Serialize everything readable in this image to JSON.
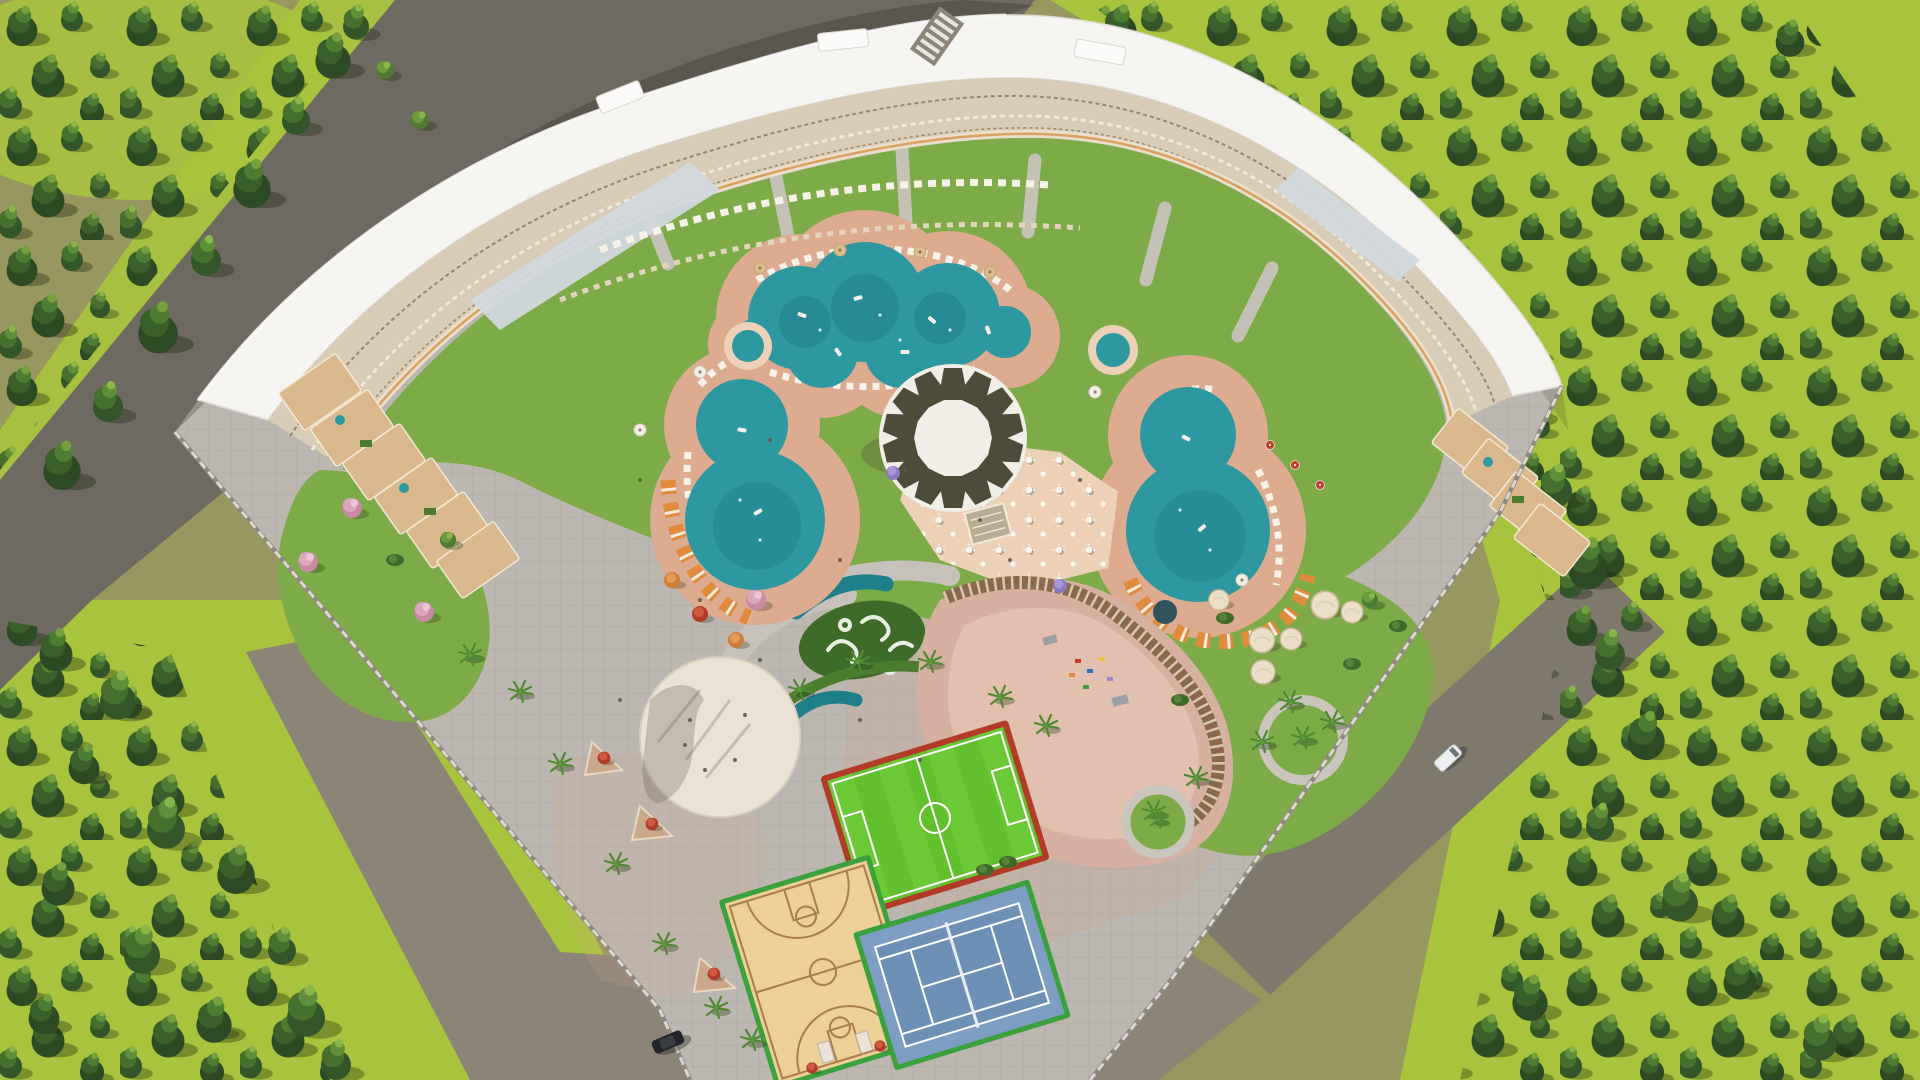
{
  "meta": {
    "title": "Aerial 3D render of a crescent-shaped resort complex with pools, sports courts and pine forest",
    "type": "architectural-visualization",
    "width_px": 1920,
    "height_px": 1080
  },
  "colors": {
    "ground_olive": "#98975f",
    "grass_lime": "#a8c43c",
    "forest_dark": "#2c4a23",
    "forest_mid": "#47702f",
    "asphalt": "#6f6a61",
    "road_gray": "#8d8478",
    "road_warm": "#7f786d",
    "paving": "#bcb8b1",
    "lawn": "#7cab47",
    "lawn_dark": "#3f6b2a",
    "deck_pink": "#ddab8f",
    "deck_light": "#ecd0b8",
    "pool_teal": "#2e98a0",
    "pool_deep": "#1e7f8a",
    "building_white": "#f5f4f1",
    "roof_sky": "#d2d8de",
    "balcony_cream": "#d8ccb6",
    "balcony_line": "#94876d",
    "terrace_tan": "#d9b88e",
    "canopy_white": "#f1eee8",
    "canopy_dark": "#4d4c38",
    "plaza_cream": "#eae2d4",
    "soccer_green": "#63c02d",
    "soccer_red": "#b23b28",
    "wood_court": "#ecd096",
    "wood_line": "#a87e4e",
    "tennis_blue": "#7e9dc2",
    "court_border_green": "#3aa13c",
    "line_white": "#ffffff",
    "cabana_orange": "#e08a3c",
    "lounger_white": "#f6f2e9",
    "dome_cream": "#ecdfca",
    "pergola_brown": "#8a6a4e",
    "flower_red": "#c43b2e",
    "car_black": "#22242a",
    "van_white": "#edeff1",
    "fence_light": "#dcd8d0"
  },
  "scene": {
    "building": {
      "name": "crescent-residence-building",
      "roof": "white flat roof with skylight strips",
      "inner_face": "terraced balconies",
      "wing_tips": "stepped tan roof terraces"
    },
    "pools": [
      {
        "name": "cloud-lagoon-pool"
      },
      {
        "name": "west-figure-eight-pool"
      },
      {
        "name": "east-figure-eight-pool"
      },
      {
        "name": "west-round-kids-pool"
      },
      {
        "name": "east-round-kids-pool"
      },
      {
        "name": "crescent-lazy-pools"
      }
    ],
    "amenities": [
      {
        "name": "central-round-canopy"
      },
      {
        "name": "outdoor-dining-terrace"
      },
      {
        "name": "event-plaza-circle"
      },
      {
        "name": "playground-with-pergola"
      },
      {
        "name": "glamping-domes"
      },
      {
        "name": "kids-water-garden"
      }
    ],
    "courts": [
      {
        "name": "football-pitch"
      },
      {
        "name": "basketball-court"
      },
      {
        "name": "tennis-court"
      }
    ],
    "vehicles": [
      {
        "name": "black-car"
      },
      {
        "name": "white-van"
      }
    ],
    "landscape": [
      {
        "name": "pine-forest-belts"
      },
      {
        "name": "lime-meadows"
      },
      {
        "name": "perimeter-roads"
      },
      {
        "name": "perimeter-fence"
      }
    ]
  }
}
